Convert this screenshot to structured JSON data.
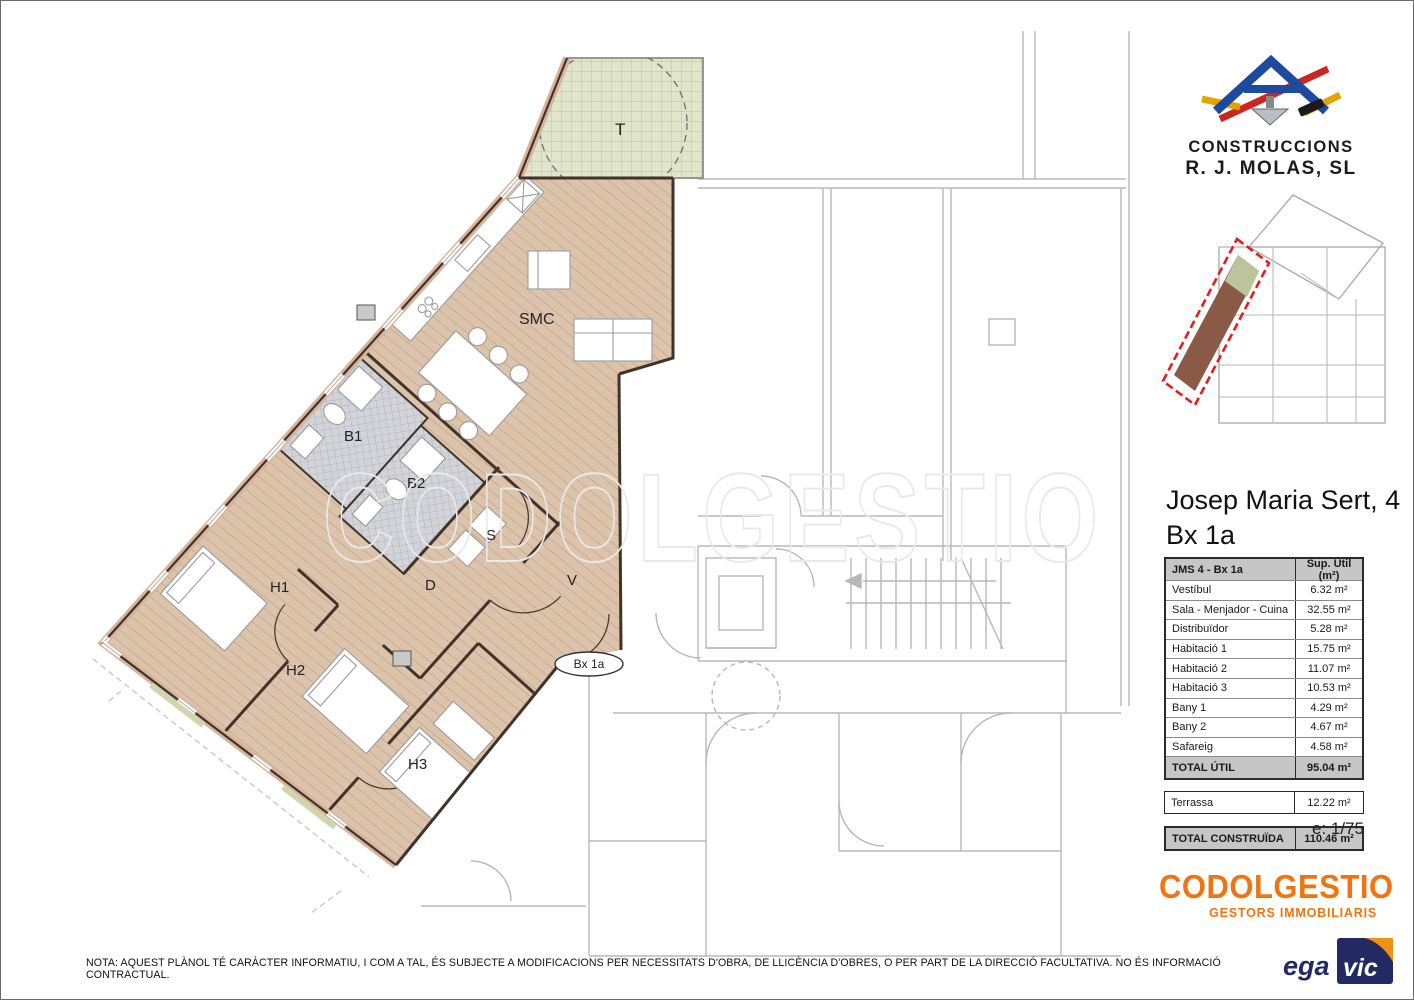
{
  "branding": {
    "builder_line1": "CONSTRUCCIONS",
    "builder_line2": "R. J. MOLAS, SL",
    "builder_colors": {
      "blue": "#1d4a9e",
      "red": "#cc2522",
      "yellow": "#e2a400"
    },
    "agency_name": "CODOLGESTIO",
    "agency_subtitle": "GESTORS IMMOBILIARIS",
    "agency_color": "#ee7511",
    "egavic_prefix": "ega",
    "egavic_suffix": "vic",
    "egavic_navy": "#232a63",
    "egavic_orange": "#f0920f"
  },
  "title": {
    "line1": "Josep Maria Sert, 4",
    "line2": "Bx 1a"
  },
  "table": {
    "header": {
      "name": "JMS 4 - Bx 1a",
      "area": "Sup. Útil (m²)"
    },
    "rooms": [
      {
        "name": "Vestíbul",
        "area": "6.32 m²"
      },
      {
        "name": "Sala - Menjador - Cuina",
        "area": "32.55 m²"
      },
      {
        "name": "Distribuïdor",
        "area": "5.28 m²"
      },
      {
        "name": "Habitació 1",
        "area": "15.75 m²"
      },
      {
        "name": "Habitació 2",
        "area": "11.07 m²"
      },
      {
        "name": "Habitació 3",
        "area": "10.53 m²"
      },
      {
        "name": "Bany 1",
        "area": "4.29 m²"
      },
      {
        "name": "Bany 2",
        "area": "4.67 m²"
      },
      {
        "name": "Safareig",
        "area": "4.58 m²"
      }
    ],
    "total_util": {
      "name": "TOTAL ÚTIL",
      "area": "95.04 m²"
    },
    "terrassa": {
      "name": "Terrassa",
      "area": "12.22 m²"
    },
    "total_constr": {
      "name": "TOTAL CONSTRUÏDA",
      "area": "110.46 m²"
    }
  },
  "scale_label": "e: 1/75",
  "note": "NOTA: AQUEST PLÀNOL TÉ CARÀCTER INFORMATIU, I COM A TAL, ÉS SUBJECTE A MODIFICACIONS PER NECESSITATS D'OBRA, DE LLICÈNCIA D'OBRES, O PER PART DE LA DIRECCIÓ FACULTATIVA.  NO ÉS INFORMACIÓ CONTRACTUAL.",
  "plan": {
    "watermark": "CODOLGESTIO",
    "unit_badge": "Bx 1a",
    "labels": {
      "terrace": "T",
      "living": "SMC",
      "bath1": "B1",
      "bath2": "B2",
      "safareig": "S",
      "distributor": "D",
      "vestibul": "V",
      "bed1": "H1",
      "bed2": "H2",
      "bed3": "H3"
    },
    "colors": {
      "floor": "#dcc3ab",
      "terrace": "#e1e5cb",
      "bath": "#d3d4da",
      "wall": "#41332a",
      "facade_fill": "#d9b49c",
      "background_lines": "#b8b8b8",
      "highlight_red": "#e01f1f",
      "mini_apartment": "#8a5a46"
    }
  }
}
